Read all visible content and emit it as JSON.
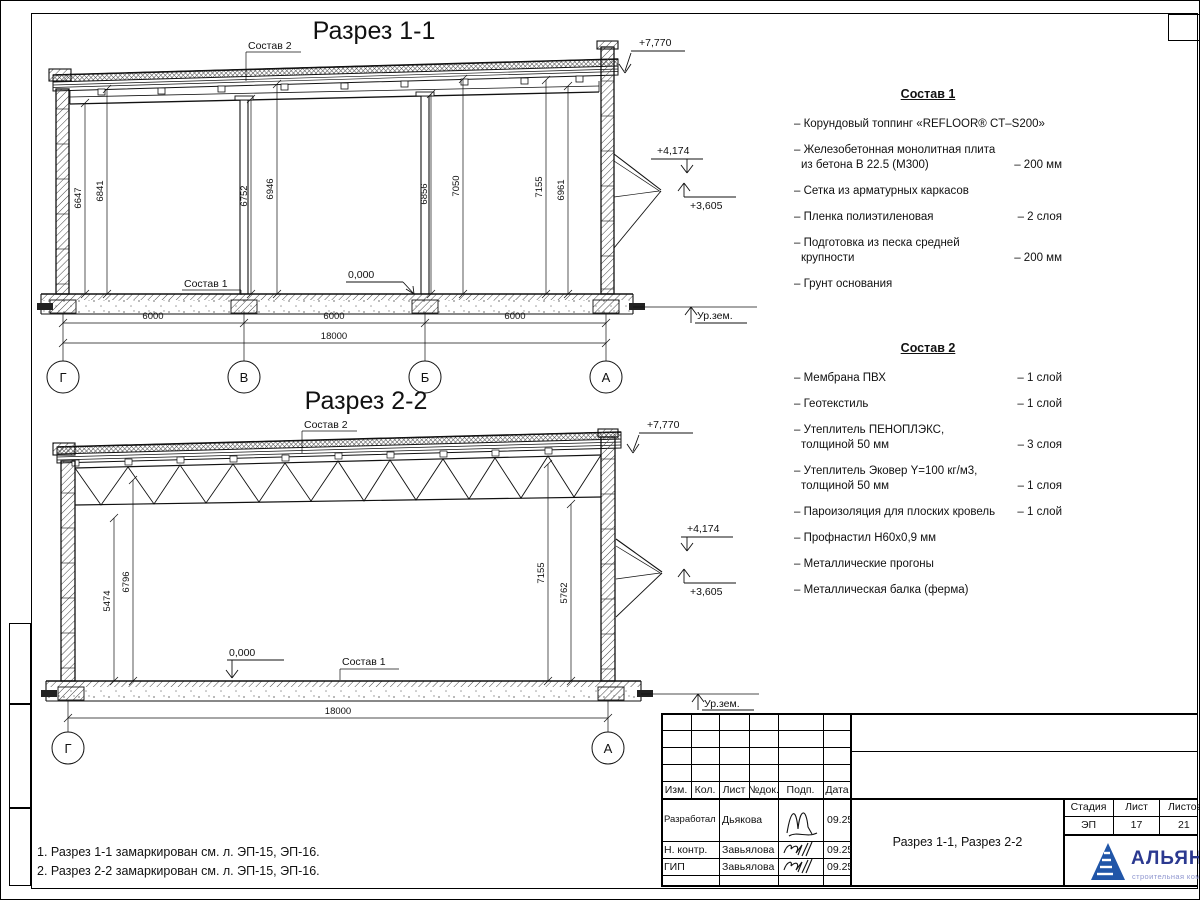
{
  "section1": {
    "title": "Разрез 1-1",
    "label_roof": "Состав 2",
    "label_floor": "Состав 1",
    "elev_roof": "+7,770",
    "elev_canopy_top": "+4,174",
    "elev_canopy_bottom": "+3,605",
    "elev_floor": "0,000",
    "elev_ground": "Ур.зем.",
    "dims_height": [
      "6647",
      "6841",
      "6752",
      "6946",
      "6856",
      "7050",
      "7155",
      "6961"
    ],
    "dims_span": [
      "6000",
      "6000",
      "6000"
    ],
    "dim_total": "18000",
    "grid_axes": [
      "Г",
      "В",
      "Б",
      "А"
    ]
  },
  "section2": {
    "title": "Разрез 2-2",
    "label_roof": "Состав 2",
    "label_floor": "Состав 1",
    "elev_roof": "+7,770",
    "elev_canopy_top": "+4,174",
    "elev_canopy_bottom": "+3,605",
    "elev_floor": "0,000",
    "elev_ground": "Ур.зем.",
    "dims_height": [
      "5474",
      "6796",
      "7155",
      "5762"
    ],
    "dim_total": "18000",
    "grid_axes": [
      "Г",
      "А"
    ]
  },
  "sostav1": {
    "title": "Состав 1",
    "items": [
      {
        "line1": "– Корундовый топпинг «REFLOOR® CT–S200»",
        "line2": "",
        "value": ""
      },
      {
        "line1": "– Железобетонная  монолитная плита",
        "line2": "из бетона В 22.5 (М300)",
        "value": "– 200 мм"
      },
      {
        "line1": "– Сетка из арматурных каркасов",
        "line2": "",
        "value": ""
      },
      {
        "line1": "– Пленка полиэтиленовая",
        "line2": "",
        "value": "– 2 слоя"
      },
      {
        "line1": "– Подготовка из песка средней",
        "line2": "крупности",
        "value": "– 200 мм"
      },
      {
        "line1": "– Грунт основания",
        "line2": "",
        "value": ""
      }
    ]
  },
  "sostav2": {
    "title": "Состав 2",
    "items": [
      {
        "line1": "– Мембрана ПВХ",
        "line2": "",
        "value": "– 1 слой"
      },
      {
        "line1": "– Геотекстиль",
        "line2": "",
        "value": "– 1 слой"
      },
      {
        "line1": "– Утеплитель ПЕНОПЛЭКС,",
        "line2": "толщиной 50 мм",
        "value": "– 3 слоя"
      },
      {
        "line1": "– Утеплитель Эковер Y=100 кг/м3,",
        "line2": "толщиной 50 мм",
        "value": "– 1 слоя"
      },
      {
        "line1": "– Пароизоляция для плоских кровель",
        "line2": "",
        "value": "– 1 слой"
      },
      {
        "line1": "– Профнастил Н60х0,9 мм",
        "line2": "",
        "value": ""
      },
      {
        "line1": "– Металлические прогоны",
        "line2": "",
        "value": ""
      },
      {
        "line1": "– Металлическая балка (ферма)",
        "line2": "",
        "value": ""
      }
    ]
  },
  "notes": {
    "line1": "1. Разрез 1-1 замаркирован см. л. ЭП-15, ЭП-16.",
    "line2": "2. Разрез 2-2 замаркирован см. л. ЭП-15, ЭП-16."
  },
  "titleblock": {
    "col_izm": "Изм.",
    "col_kol": "Кол.",
    "col_list": "Лист",
    "col_ndok": "№док.",
    "col_podp": "Подп.",
    "col_data": "Дата",
    "row1_role": "Разработал",
    "row1_name": "Дьякова",
    "row1_date": "09.25",
    "row2_role": "Н. контр.",
    "row2_name": "Завьялова",
    "row2_date": "09.25",
    "row3_role": "ГИП",
    "row3_name": "Завьялова",
    "row3_date": "09.25",
    "doc_name": "Разрез 1-1, Разрез 2-2",
    "stage_label": "Стадия",
    "sheet_label": "Лист",
    "sheets_label": "Листов",
    "stage": "ЭП",
    "sheet_no": "17",
    "sheets_total": "21",
    "company_name": "АЛЬЯНС",
    "company_sub": "строительная компания",
    "brand_blue": "#2b3990",
    "brand_light": "#8f96cf"
  }
}
